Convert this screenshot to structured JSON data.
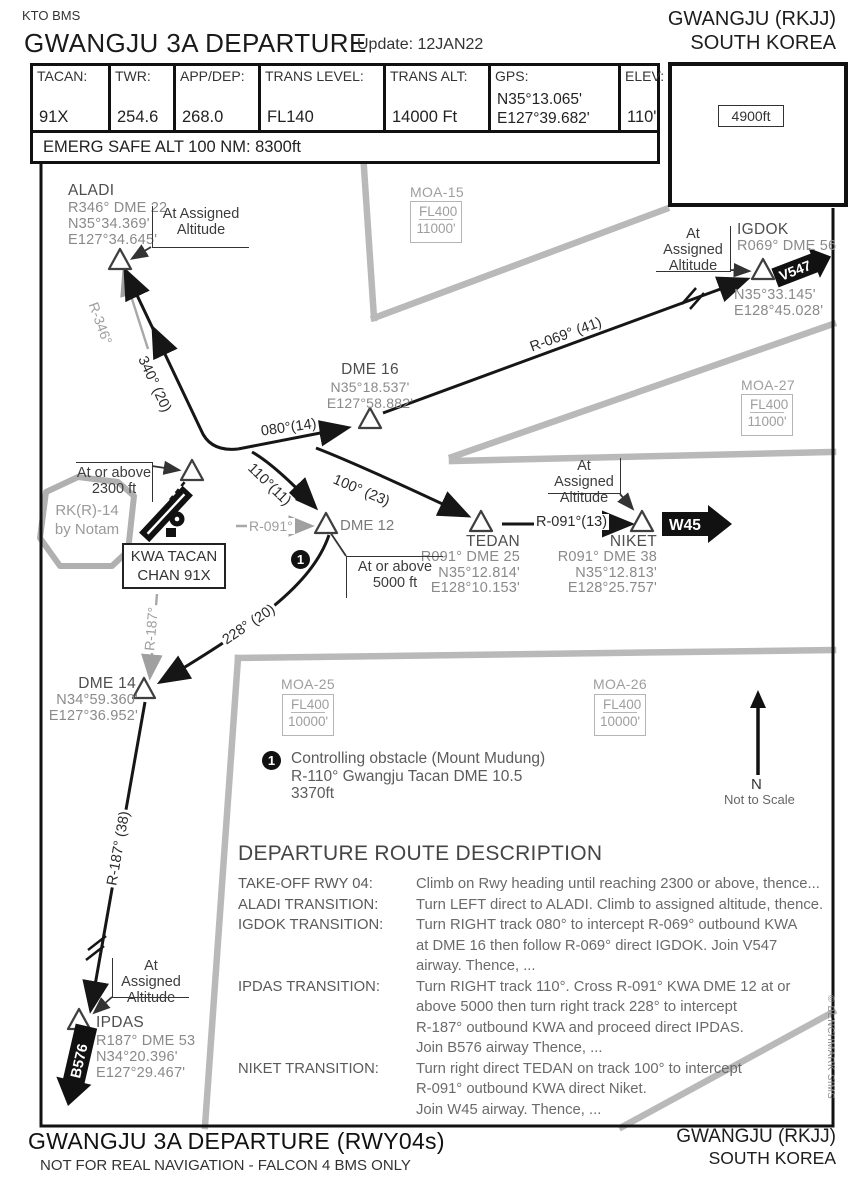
{
  "header": {
    "issuer": "KTO BMS",
    "title": "GWANGJU 3A DEPARTURE",
    "update": "Update: 12JAN22",
    "airport": "GWANGJU (RKJJ)",
    "country": "SOUTH KOREA",
    "info_cells": [
      {
        "label": "TACAN:",
        "value": "91X"
      },
      {
        "label": "TWR:",
        "value": "254.6"
      },
      {
        "label": "APP/DEP:",
        "value": "268.0"
      },
      {
        "label": "TRANS LEVEL:",
        "value": "FL140"
      },
      {
        "label": "TRANS ALT:",
        "value": "14000 Ft"
      },
      {
        "label": "GPS:",
        "value": "N35°13.065'\nE127°39.682'"
      },
      {
        "label": "ELEV:",
        "value": "110'"
      }
    ],
    "emerg": "EMERG SAFE ALT 100 NM: 8300ft",
    "msa": {
      "arc": "MSA 25 Nm",
      "alt": "4900ft"
    }
  },
  "waypoints": {
    "aladi": {
      "name": "ALADI",
      "data": "R346° DME 22\nN35°34.369'\nE127°34.645'"
    },
    "igdok": {
      "name": "IGDOK",
      "ident": "R069° DME 56",
      "coords": "N35°33.145'\nE128°45.028'"
    },
    "dme16": {
      "name": "DME 16",
      "coords": "N35°18.537'\nE127°58.882'"
    },
    "dme12": {
      "name": "DME 12"
    },
    "tedan": {
      "name": "TEDAN",
      "data": "R091° DME 25\nN35°12.814'\nE128°10.153'"
    },
    "niket": {
      "name": "NIKET",
      "data": "R091° DME 38\nN35°12.813'\nE128°25.757'"
    },
    "dme14": {
      "name": "DME 14",
      "coords": "N34°59.360'\nE127°36.952'"
    },
    "ipdas": {
      "name": "IPDAS",
      "data": "R187° DME 53\nN34°20.396'\nE127°29.467'"
    }
  },
  "constraints": {
    "at_assigned": "At Assigned\nAltitude",
    "at_2300": "At or above\n2300 ft",
    "at_5000": "At or above\n5000 ft"
  },
  "track_labels": {
    "t340": "340° (20)",
    "t080": "080°(14)",
    "r069": "R-069° (41)",
    "t110": "110°(11)",
    "t100": "100° (23)",
    "r091_13": "R-091°(13)",
    "t228": "228° (20)",
    "r187_38": "R-187° (38)",
    "r346": "R-346°",
    "r091": "R-091°",
    "r187": "R-187°"
  },
  "badges": {
    "v547": "V547",
    "w45": "W45",
    "b576": "B576"
  },
  "areas": {
    "rk14": "RK(R)-14\nby Notam",
    "kwa": "KWA TACAN\nCHAN 91X",
    "moa15": {
      "name": "MOA-15",
      "upper": "FL400",
      "lower": "11000'"
    },
    "moa27": {
      "name": "MOA-27",
      "upper": "FL400",
      "lower": "11000'"
    },
    "moa25": {
      "name": "MOA-25",
      "upper": "FL400",
      "lower": "10000'"
    },
    "moa26": {
      "name": "MOA-26",
      "upper": "FL400",
      "lower": "10000'"
    }
  },
  "note": {
    "marker": "1",
    "text": "Controlling obstacle (Mount Mudung)\nR-110° Gwangju Tacan DME 10.5\n3370ft"
  },
  "compass": {
    "n": "N",
    "scale": "Not to Scale"
  },
  "route": {
    "title": "DEPARTURE ROUTE DESCRIPTION",
    "items": [
      {
        "label": "TAKE-OFF RWY 04:",
        "text": "Climb on Rwy heading until reaching 2300 or above, thence..."
      },
      {
        "label": "ALADI TRANSITION:",
        "text": "Turn LEFT direct to ALADI. Climb to assigned altitude, thence."
      },
      {
        "label": "IGDOK TRANSITION:",
        "text": "Turn RIGHT track 080° to intercept R-069° outbound KWA\nat DME 16 then follow R-069° direct IGDOK. Join V547\nairway. Thence, ..."
      },
      {
        "label": "IPDAS TRANSITION:",
        "text": "Turn RIGHT track 110°. Cross R-091° KWA DME 12 at or\nabove 5000 then turn right track 228° to intercept\nR-187° outbound KWA and proceed direct IPDAS.\nJoin B576 airway Thence, ..."
      },
      {
        "label": "NIKET TRANSITION:",
        "text": "Turn right direct TEDAN on track 100° to intercept\nR-091° outbound KWA direct Niket.\nJoin W45 airway. Thence, ..."
      }
    ]
  },
  "footer": {
    "title": "GWANGJU 3A DEPARTURE (RWY04s)",
    "disclaimer": "NOT FOR REAL NAVIGATION - FALCON 4 BMS ONLY",
    "airport": "GWANGJU (RKJJ)",
    "country": "SOUTH KOREA"
  },
  "copyright": "© BENCHMARK SIMS"
}
